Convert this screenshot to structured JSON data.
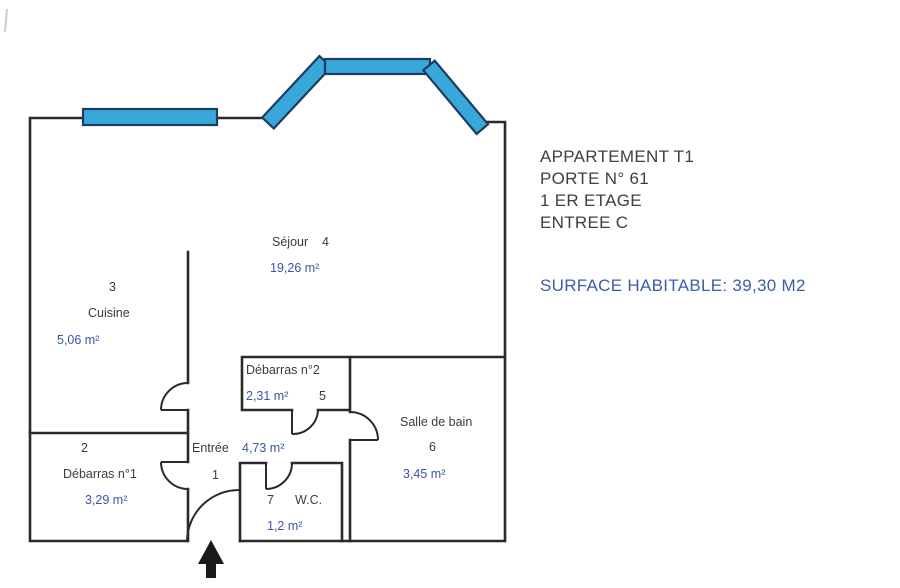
{
  "info_panel": {
    "line1": "APPARTEMENT T1",
    "line2": "PORTE N° 61",
    "line3": "1 ER ETAGE",
    "line4": "ENTREE C",
    "surface": "SURFACE HABITABLE: 39,30 M2"
  },
  "rooms": {
    "entree": {
      "number": "1",
      "name": "Entrée",
      "area": "4,73 m²"
    },
    "debarras1": {
      "number": "2",
      "name": "Débarras n°1",
      "area": "3,29 m²"
    },
    "cuisine": {
      "number": "3",
      "name": "Cuisine",
      "area": "5,06 m²"
    },
    "sejour": {
      "number": "4",
      "name": "Séjour",
      "area": "19,26 m²"
    },
    "debarras2": {
      "number": "5",
      "name": "Débarras n°2",
      "area": "2,31 m²"
    },
    "salle_de_bain": {
      "number": "6",
      "name": "Salle de bain",
      "area": "3,45 m²"
    },
    "wc": {
      "number": "7",
      "name": "W.C.",
      "area": "1,2 m²"
    }
  },
  "colors": {
    "window_fill": "#38a8da",
    "window_border": "#1d3d60",
    "wall": "#2a2a2a",
    "area_text": "#3a55a4",
    "label_text": "#3b3b3b",
    "surface_text": "#3c5da8",
    "arrow": "#1a1a1a"
  }
}
